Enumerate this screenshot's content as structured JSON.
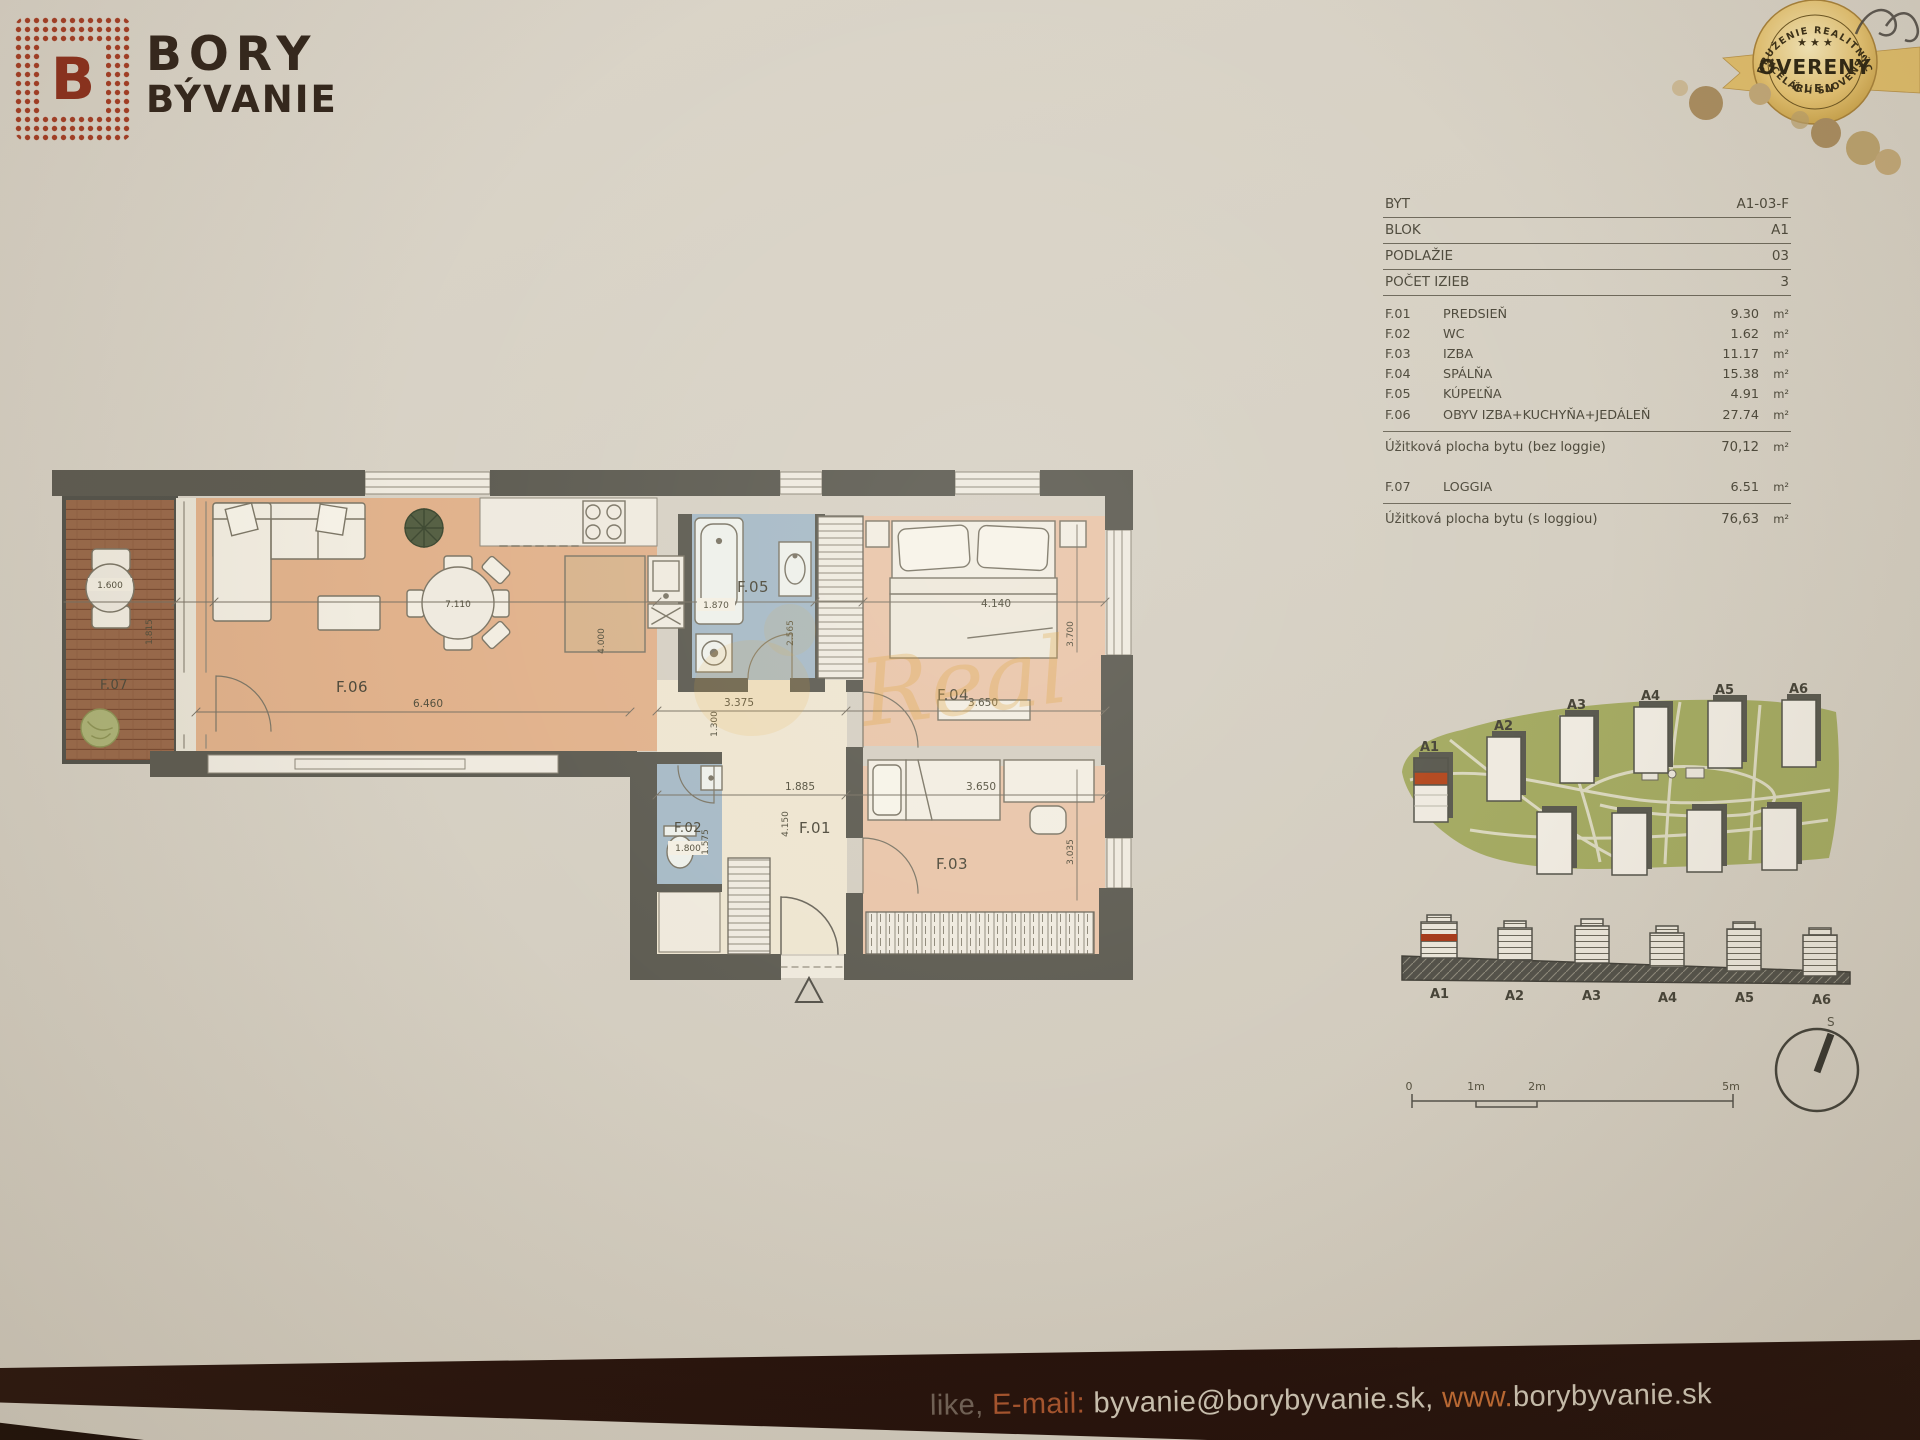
{
  "header": {
    "logo_letter": "B",
    "brand_line1": "BORY",
    "brand_line2": "BÝVANIE"
  },
  "badge": {
    "arc_top": "ZDRUŽENIE REALITNÝCH",
    "stars": "★ ★ ★",
    "title": "OVERENÝ",
    "subtitle": "ČLEN",
    "arc_bottom": "KANCELÁRIÍ SLOVENSKA"
  },
  "info_table": {
    "meta": [
      {
        "label": "BYT",
        "value": "A1-03-F"
      },
      {
        "label": "BLOK",
        "value": "A1"
      },
      {
        "label": "PODLAŽIE",
        "value": "03"
      },
      {
        "label": "POČET IZIEB",
        "value": "3"
      }
    ],
    "rooms": [
      {
        "code": "F.01",
        "name": "PREDSIEŇ",
        "area": "9.30"
      },
      {
        "code": "F.02",
        "name": "WC",
        "area": "1.62"
      },
      {
        "code": "F.03",
        "name": "IZBA",
        "area": "11.17"
      },
      {
        "code": "F.04",
        "name": "SPÁLŇA",
        "area": "15.38"
      },
      {
        "code": "F.05",
        "name": "KÚPEĽŇA",
        "area": "4.91"
      },
      {
        "code": "F.06",
        "name": "OBYV IZBA+KUCHYŇA+JEDÁLEŇ",
        "area": "27.74"
      }
    ],
    "unit": "m²",
    "subtotal_label": "Úžitková plocha bytu (bez loggie)",
    "subtotal_area": "70,12",
    "loggia": {
      "code": "F.07",
      "name": "LOGGIA",
      "area": "6.51"
    },
    "total_label": "Úžitková plocha bytu (s loggiou)",
    "total_area": "76,63"
  },
  "plan": {
    "room_labels": {
      "f01": "F.01",
      "f02": "F.02",
      "f03": "F.03",
      "f04": "F.04",
      "f05": "F.05",
      "f06": "F.06",
      "f07": "F.07"
    },
    "dims": {
      "loggia_table": "1.600",
      "loggia_depth": "1.815",
      "dining_table": "7.110",
      "living_width": "6.460",
      "kitchen_island": "4.000",
      "bathtub": "1.870",
      "bath_depth": "2.565",
      "hall_width": "3.375",
      "hall_nook": "1.300",
      "hall_lower_width": "1.885",
      "hall_depth": "4.150",
      "wc_width": "1.800",
      "wc_depth": "1.575",
      "bed_width": "4.140",
      "bedroom_depth": "3.700",
      "bedroom_width": "3.650",
      "room3_width": "3.650",
      "room3_depth": "3.035"
    },
    "watermark": "Real"
  },
  "site": {
    "block_labels": [
      "A1",
      "A2",
      "A3",
      "A4",
      "A5",
      "A6"
    ],
    "elevation_labels": [
      "A1",
      "A2",
      "A3",
      "A4",
      "A5",
      "A6"
    ],
    "compass": "S",
    "scale": [
      "0",
      "1m",
      "2m",
      "5m"
    ]
  },
  "footer": {
    "fragment": "like,",
    "email_label": " E-mail: ",
    "email": "byvanie@borybyvanie.sk, ",
    "www": "www.",
    "site": "borybyvanie.sk"
  }
}
